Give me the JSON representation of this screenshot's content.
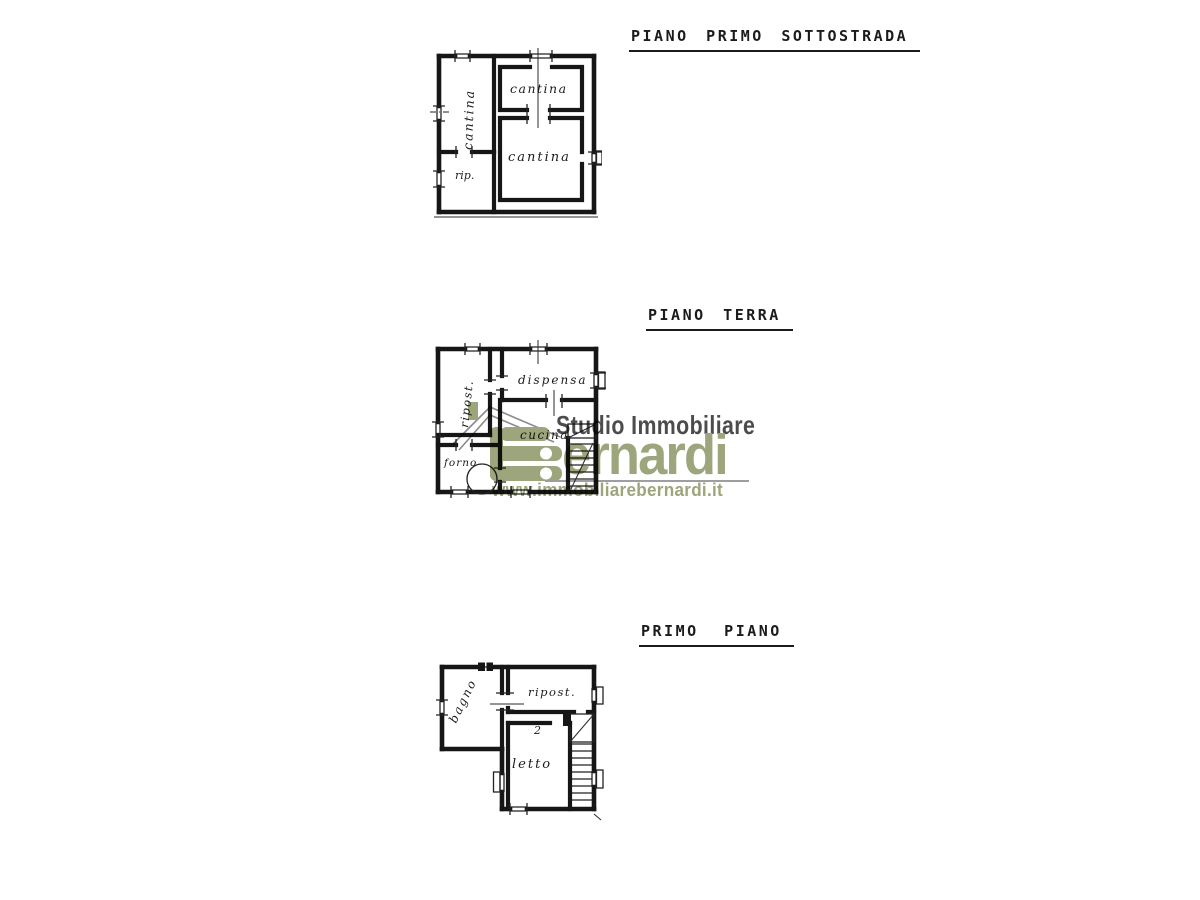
{
  "page": {
    "background": "#ffffff"
  },
  "floors": [
    {
      "title": "PIANO PRIMO SOTTOSTRADA",
      "rooms": [
        {
          "label": "cantina",
          "orientation": "vertical"
        },
        {
          "label": "cantina",
          "orientation": "horizontal"
        },
        {
          "label": "cantina",
          "orientation": "horizontal"
        },
        {
          "label": "rip.",
          "orientation": "horizontal"
        }
      ]
    },
    {
      "title": "PIANO TERRA",
      "rooms": [
        {
          "label": "ripost.",
          "orientation": "vertical"
        },
        {
          "label": "dispensa",
          "orientation": "horizontal"
        },
        {
          "label": "cucina",
          "orientation": "horizontal"
        },
        {
          "label": "forno",
          "orientation": "horizontal"
        }
      ]
    },
    {
      "title": "PRIMO PIANO",
      "rooms": [
        {
          "label": "bagno",
          "orientation": "diagonal"
        },
        {
          "label": "ripost.",
          "orientation": "horizontal"
        },
        {
          "label": "letto",
          "orientation": "horizontal"
        }
      ],
      "stair_annotation": "2"
    }
  ],
  "watermark": {
    "studio_text": "Studio Immobiliare",
    "brand_display": "ernardi",
    "brand_full": "Bernardi",
    "website": "www.immobiliarebernardi.it",
    "colors": {
      "green": "#9ca57c",
      "gray": "#4c4c4c",
      "rule": "#9e9e9e"
    }
  }
}
